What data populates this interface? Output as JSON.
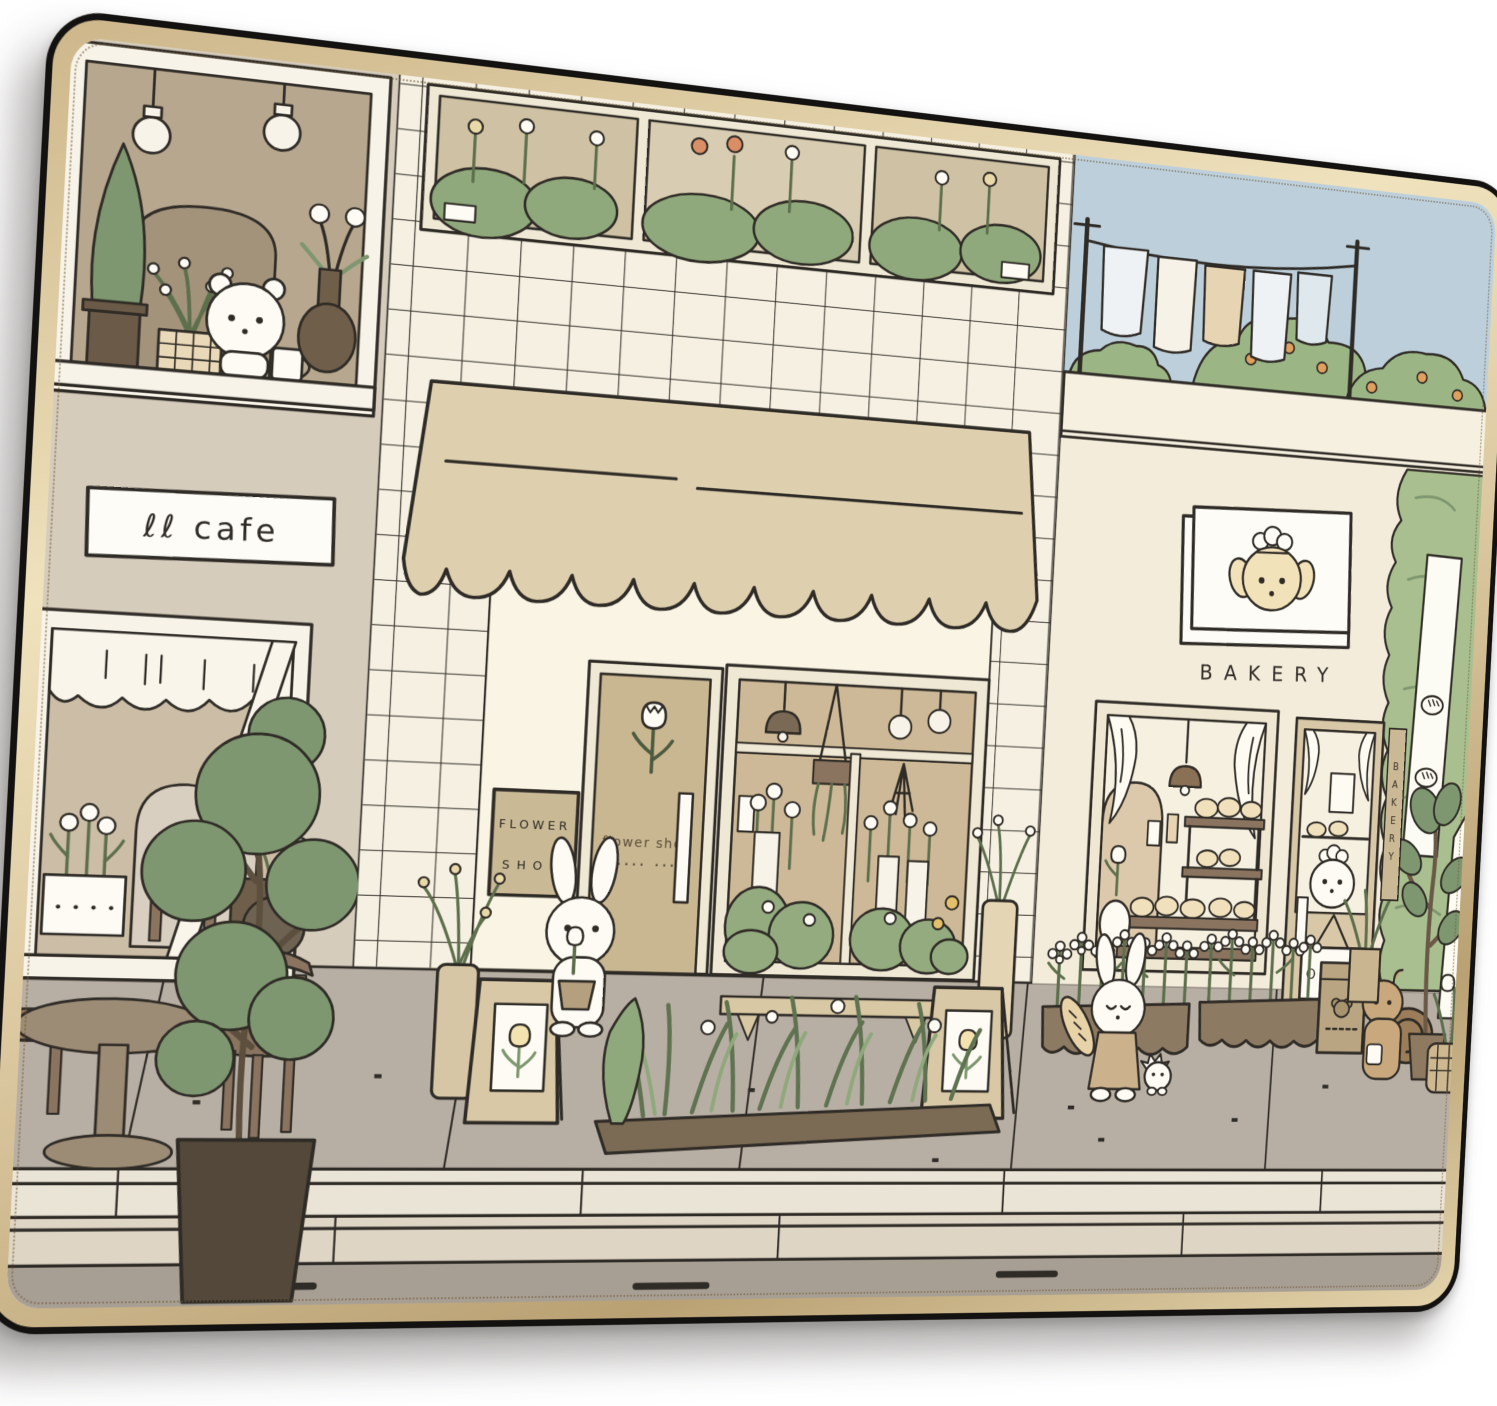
{
  "scene": {
    "cafe": {
      "sign_text": "ℓℓ cafe"
    },
    "flower_shop": {
      "plaque_line1": "FLOWER",
      "plaque_line2": "SHOP",
      "door_label": "flower shop",
      "door_dots": "···· ···"
    },
    "bakery": {
      "sign_label": "BAKERY",
      "vertical_sign": "BAKERY",
      "open_sign": "OPEN"
    },
    "characters": {
      "cafe_bear": "bear with mug",
      "flower_bunny": "bunny holding potted tulip",
      "bakery_bunny": "bunny holding baguette",
      "hedgehog": "small hedgehog",
      "squirrel": "squirrel by bakery",
      "bakery_dog": "chef dog"
    },
    "palette": {
      "ink": "#2f2b26",
      "pad_rim": "#141210",
      "pad_edge_gold": "#d9c5a0",
      "cafe_wall": "#d6ccbc",
      "tile_wall": "#f5f0e1",
      "awning": "#decfae",
      "storefront": "#f9f4e3",
      "bakery_wall": "#f3ecda",
      "sky": "#bccfdb",
      "foliage": "#8fa87c",
      "sidewalk": "#b8afa4",
      "curb": "#eae4d6",
      "road": "#a89f94"
    }
  }
}
